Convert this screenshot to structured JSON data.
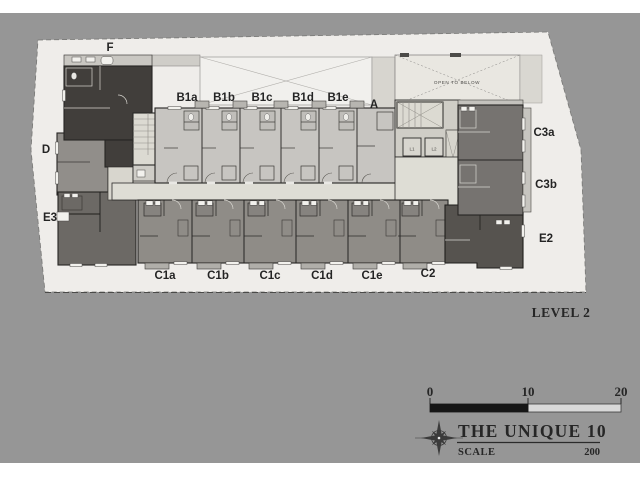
{
  "plan": {
    "level_label": "LEVEL 2",
    "open_to_below_label": "OPEN TO BELOW",
    "top_units": [
      "B1a",
      "B1b",
      "B1c",
      "B1d",
      "B1e"
    ],
    "unit_a": "A",
    "left_units": {
      "f": "F",
      "d": "D",
      "e3": "E3"
    },
    "right_units": {
      "c3a": "C3a",
      "c3b": "C3b",
      "e2": "E2"
    },
    "bottom_units": [
      "C1a",
      "C1b",
      "C1c",
      "C1d",
      "C1e",
      "C2"
    ],
    "elevators": [
      "L1",
      "L2"
    ]
  },
  "title_block": {
    "project_name": "THE UNIQUE 10",
    "scale_label": "SCALE",
    "scale_value": "200",
    "scale_bar_ticks": [
      "0",
      "10",
      "20"
    ]
  },
  "colors": {
    "canvas": "#969696",
    "site": "#efedea",
    "unit_light": "#c7c5c1",
    "unit_medium": "#8f8c87",
    "unit_dark": "#413e3b",
    "unit_darker": "#6c6965",
    "unit_d": "#918e8a",
    "right_wing": "#767370",
    "unit_e2": "#56534f",
    "corridor": "#deddd5",
    "core": "#dcdad2",
    "void": "#f1f0ed",
    "open_below": "#e9e7e1",
    "balcony": "#b3b1ac",
    "bar_dark": "#161616",
    "bar_light": "#d9d9d9"
  }
}
